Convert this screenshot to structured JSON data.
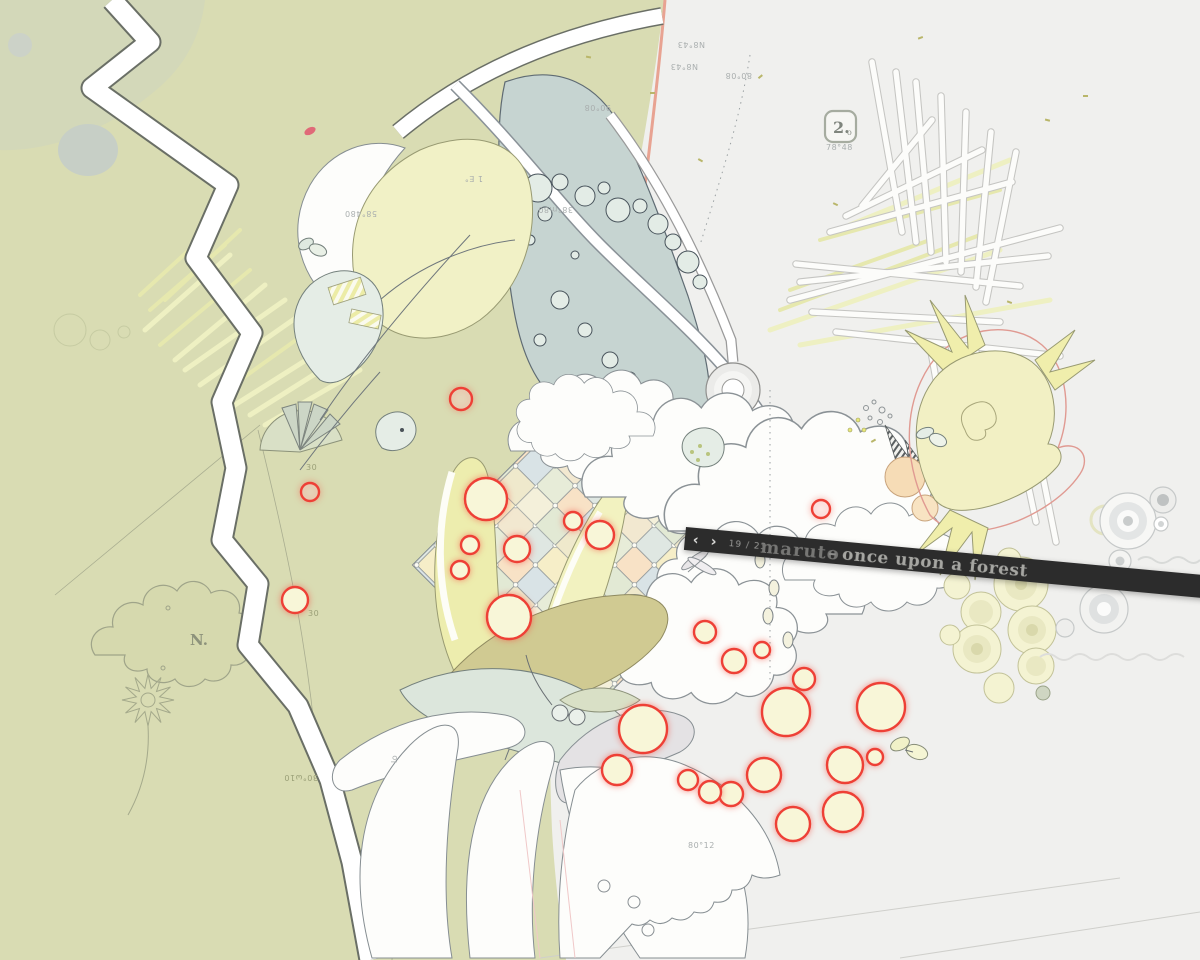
{
  "app_title": "maruto – once upon a forest",
  "canvas": {
    "width": 1200,
    "height": 960
  },
  "navbar": {
    "prev": "‹",
    "next": "›",
    "counter": "19 / 23",
    "brand": "maruto",
    "dash": "–",
    "title": "once upon a forest"
  },
  "badge": {
    "number": "2.",
    "sub": "o",
    "coords": "78°48"
  },
  "labels": {
    "compass": "N.",
    "top_small": "N8°43",
    "top_large": "N8°43",
    "top_right": "80°08",
    "lake_upper": "90°08",
    "lake_mid": "38°m80",
    "lake_note": "1 E°",
    "leaf_note": "58°480",
    "ground_note": "30°ω10",
    "stem_note": "lo",
    "petal_note": "80°12",
    "fan_note": "30"
  },
  "colors": {
    "bgLeft": "#d9dcb3",
    "bgRight": "#f0f0ee",
    "bar": "#2c2c2c",
    "red": "#ee4036",
    "berry": "#f8f6d8",
    "lake": "#c6d4d1",
    "salmon": "#e8a392",
    "ink": "#6f777c"
  }
}
